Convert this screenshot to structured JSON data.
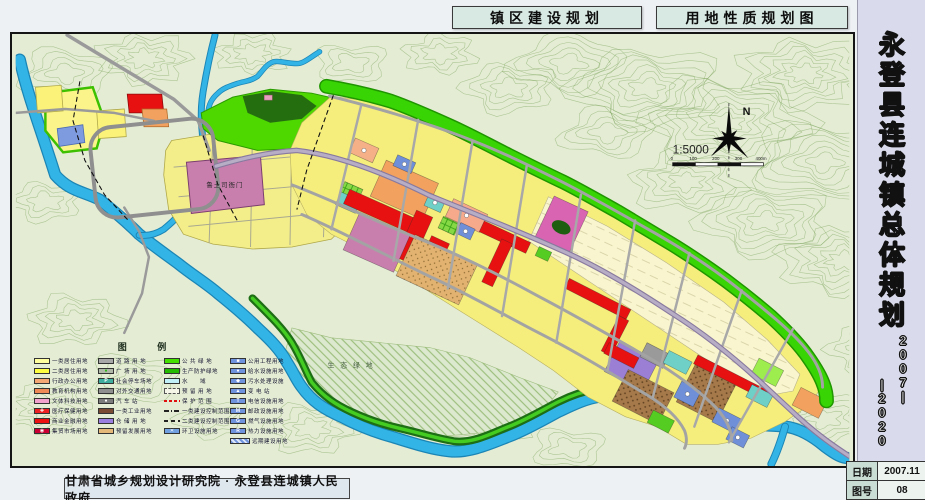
{
  "header": {
    "title_left": "镇区建设规划",
    "title_right": "用地性质规划图"
  },
  "sidebar": {
    "title": "永登县连城镇总体规划",
    "year_start": "2007",
    "year_end": "2020",
    "year_separator": "|",
    "date_label": "日期",
    "date_value": "2007.11",
    "sheet_label": "图号",
    "sheet_value": "08"
  },
  "footer": {
    "credit": "甘肃省城乡规划设计研究院 · 永登县连城镇人民政府"
  },
  "map": {
    "labels": {
      "heritage": "鲁土司衙门",
      "eco": "生 态 绿 地"
    },
    "north_label": "N",
    "scale_text": "1:5000",
    "scale_ticks": [
      "0",
      "100",
      "200",
      "300",
      "400m"
    ],
    "colors": {
      "terrain": "#e4ecd4",
      "contour": "#7da55c",
      "river": "#33b4e6",
      "residential_yellow": "#f5ee7d",
      "green_belt": "#38d403",
      "commercial_red": "#e81111",
      "heritage_pink": "#c97fae"
    }
  },
  "legend": {
    "title": "图 例",
    "columns": [
      {
        "items": [
          {
            "label": "一类居住用地",
            "bg": "#ffff9e"
          },
          {
            "label": "二类居住用地",
            "bg": "#ffff42"
          },
          {
            "label": "行政办公用地",
            "bg": "#f5a873"
          },
          {
            "label": "教育机构用地",
            "bg": "#ef8a56"
          },
          {
            "label": "文体科技用地",
            "bg": "#f2a2cc"
          },
          {
            "label": "医疗保健用地",
            "bg": "#ee2222",
            "glyph": "✚"
          },
          {
            "label": "商业金融用地",
            "bg": "#ee1111"
          },
          {
            "label": "集贸市场用地",
            "bg": "#cc0033",
            "glyph": "◉"
          }
        ]
      },
      {
        "items": [
          {
            "label": "道 路 用 地",
            "bg": "#a8a8a8"
          },
          {
            "label": "广 场 用 地",
            "bg": "#b0b8a8",
            "glyph": "●",
            "glyphColor": "#2db515"
          },
          {
            "label": "社会停车场地",
            "bg": "#3fae9f",
            "glyph": "P"
          },
          {
            "label": "对外交通用地",
            "bg": "#8f8f8f"
          },
          {
            "label": "汽 车 站",
            "bg": "#7c7c7c",
            "glyph": "●"
          },
          {
            "label": "一类工业用地",
            "bg": "#7a4a32"
          },
          {
            "label": "仓 储 用 地",
            "bg": "#9b7fe0"
          },
          {
            "label": "预留发展用地",
            "bg": "#e3b878"
          }
        ]
      },
      {
        "items": [
          {
            "label": "公 共 绿 地",
            "bg": "#44e000"
          },
          {
            "label": "生产防护绿地",
            "bg": "#22bb00"
          },
          {
            "label": "水　　域",
            "bg": "#c2f0f8"
          },
          {
            "label": "预 留 用 地",
            "cls": "outline-dash"
          },
          {
            "label": "保 护 范 围",
            "cls": "line-red"
          },
          {
            "label": "一类建设控制范围",
            "cls": "line-dashdot"
          },
          {
            "label": "二类建设控制范围",
            "cls": "line-dash"
          },
          {
            "label": "环卫设施用地",
            "bg": "#6f9fe0",
            "glyph": "✕"
          }
        ]
      },
      {
        "items": [
          {
            "label": "公用工程用地",
            "bg": "#6f93dd",
            "glyph": "■"
          },
          {
            "label": "给水设施用地",
            "bg": "#6f93dd",
            "glyph": "●"
          },
          {
            "label": "污水处理设施",
            "bg": "#6f93dd",
            "glyph": "◆"
          },
          {
            "label": "变 电 站",
            "bg": "#6f93dd",
            "glyph": "▲"
          },
          {
            "label": "电信设施用地",
            "bg": "#6f93dd",
            "glyph": "T"
          },
          {
            "label": "邮政设施用地",
            "bg": "#6f93dd",
            "glyph": "M"
          },
          {
            "label": "燃气设施用地",
            "bg": "#6f93dd",
            "glyph": "G"
          },
          {
            "label": "热力设施用地",
            "bg": "#6f93dd",
            "glyph": "R"
          },
          {
            "label": "远期建设用地",
            "cls": "hatch-blue"
          }
        ]
      }
    ]
  }
}
